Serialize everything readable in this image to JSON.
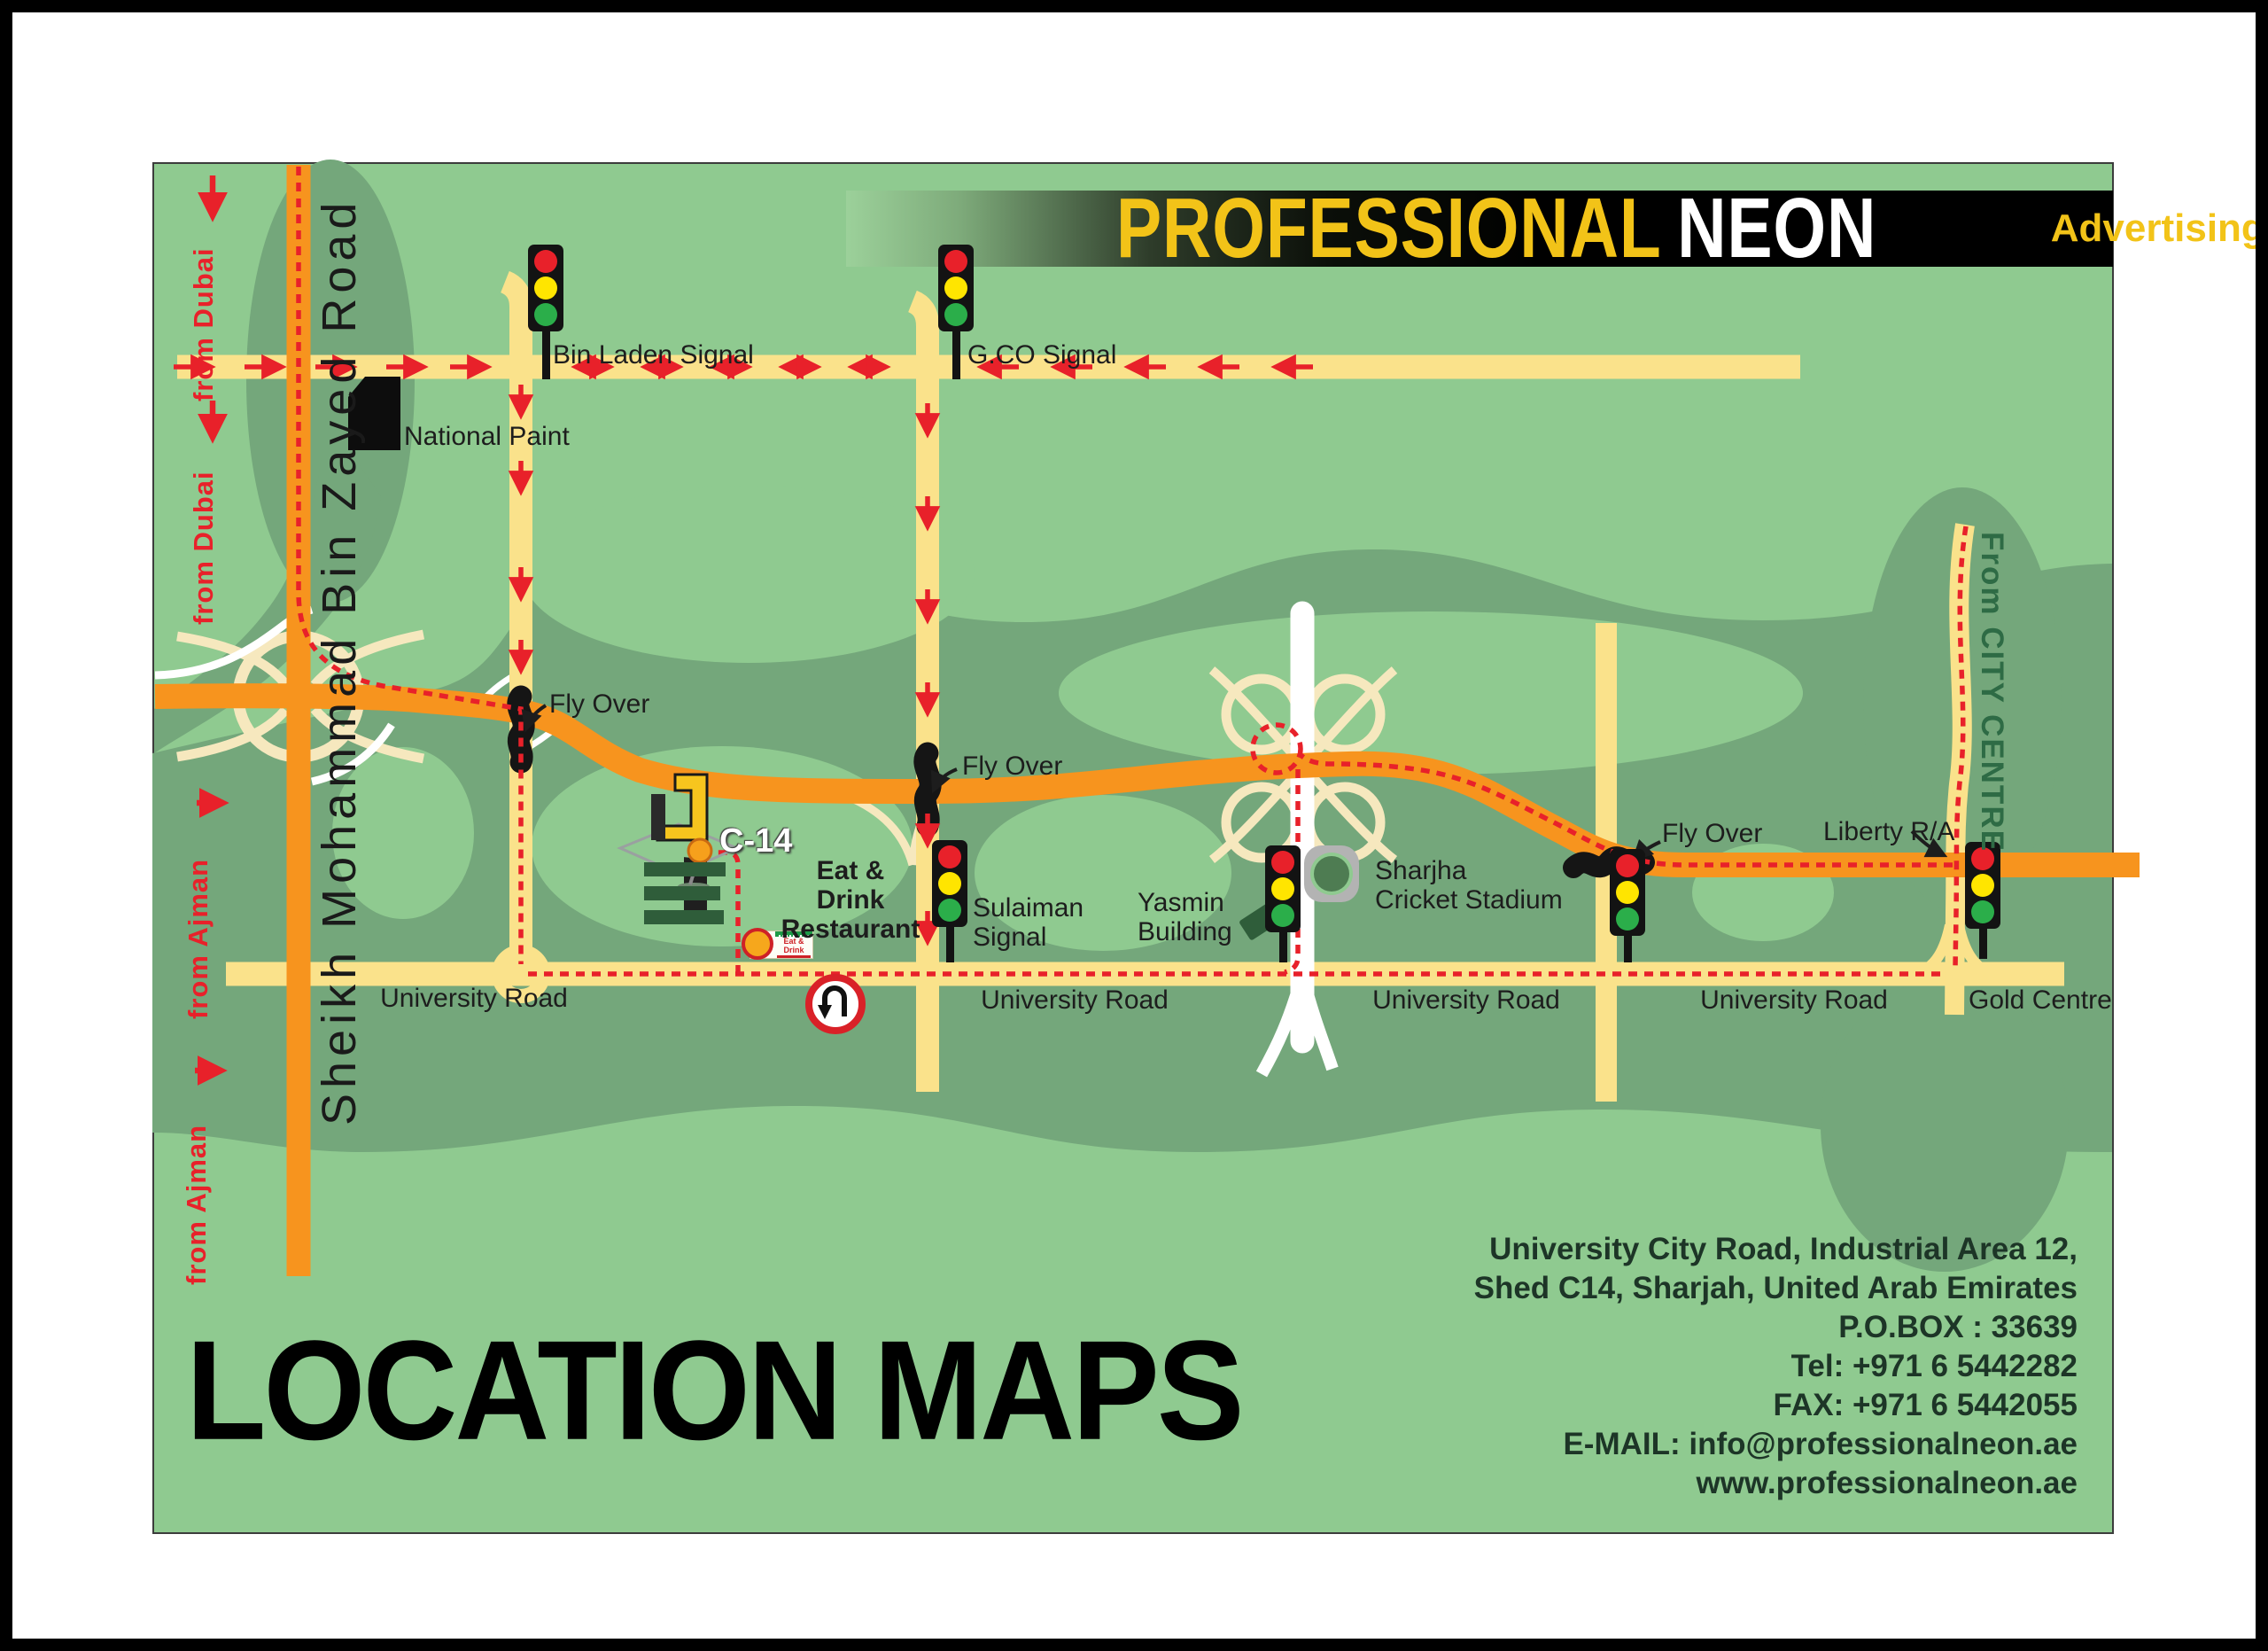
{
  "header": {
    "brand_primary": "PROFESSIONAL",
    "brand_secondary": "NEON",
    "brand_tagline": "Advertising"
  },
  "title": "LOCATION MAPS",
  "contact": {
    "lines": [
      "University City Road, Industrial Area 12,",
      "Shed C14, Sharjah, United Arab Emirates",
      "P.O.BOX : 33639",
      "Tel: +971 6 5442282",
      "FAX: +971 6 5442055",
      "E-MAIL: info@professionalneon.ae",
      "www.professionalneon.ae"
    ]
  },
  "map": {
    "labels": {
      "from_dubai": "from Dubai",
      "from_ajman": "from Ajman",
      "smbz_road": "Sheikh Mohammad Bin Zayed Road",
      "from_city_centre": "From CITY CENTRE",
      "bin_laden_signal": "Bin Laden Signal",
      "gco_signal": "G.CO Signal",
      "national_paint": "National Paint",
      "fly_over": "Fly Over",
      "c14": "C-14",
      "eat_drink_1": "Eat & Drink",
      "eat_drink_2": "Restaurant",
      "sulaiman_1": "Sulaiman",
      "sulaiman_2": "Signal",
      "yasmin_1": "Yasmin",
      "yasmin_2": "Building",
      "stadium_1": "Sharjha",
      "stadium_2": "Cricket Stadium",
      "liberty": "Liberty R/A",
      "gold_centre": "Gold Centre",
      "university_road": "University Road"
    },
    "badge": {
      "eat_drink": "Eat & Drink"
    },
    "colors": {
      "map_green": "#8FCA90",
      "map_dark_green": "#74A77B",
      "road_yellow": "#FAE28B",
      "road_orange": "#F7941E",
      "route_red": "#E8212A",
      "brand_yellow": "#F2C318"
    }
  }
}
